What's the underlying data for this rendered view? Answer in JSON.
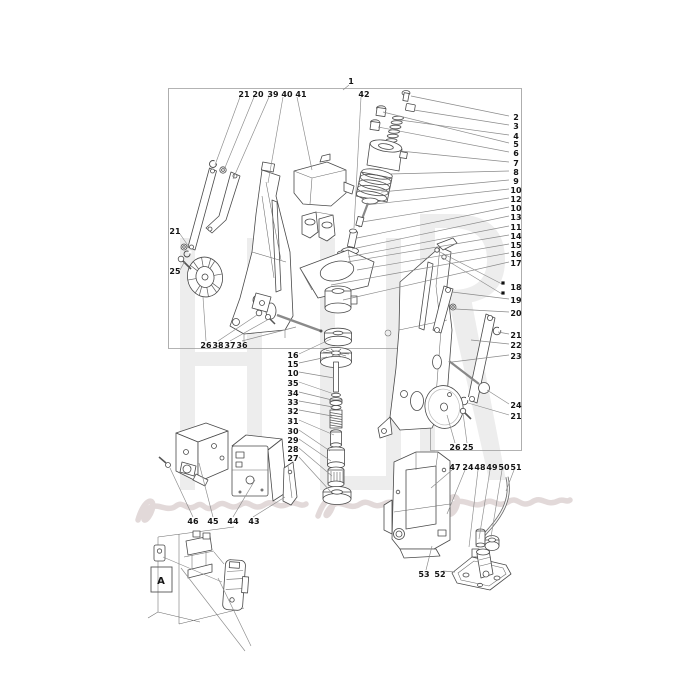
{
  "page": {
    "background": "#ffffff",
    "border_color": "#9a9a9a",
    "drawing_stroke": "#4a4a4a",
    "leader_color": "#8a8a8a",
    "label_color": "#151515",
    "watermark_color": "#ededed",
    "watermark_script_color": "#ddd2d2"
  },
  "figure": {
    "kind": "exploded-parts-diagram",
    "detail_view_label": "A"
  },
  "callouts": [
    {
      "t": "21",
      "x": 244,
      "y": 94
    },
    {
      "t": "20",
      "x": 258,
      "y": 94
    },
    {
      "t": "39",
      "x": 273,
      "y": 94
    },
    {
      "t": "40",
      "x": 287,
      "y": 94
    },
    {
      "t": "41",
      "x": 301,
      "y": 94
    },
    {
      "t": "1",
      "x": 351,
      "y": 81
    },
    {
      "t": "42",
      "x": 364,
      "y": 94
    },
    {
      "t": "2",
      "x": 516,
      "y": 117
    },
    {
      "t": "3",
      "x": 516,
      "y": 126
    },
    {
      "t": "4",
      "x": 516,
      "y": 136
    },
    {
      "t": "5",
      "x": 516,
      "y": 144
    },
    {
      "t": "6",
      "x": 516,
      "y": 153
    },
    {
      "t": "7",
      "x": 516,
      "y": 163
    },
    {
      "t": "8",
      "x": 516,
      "y": 172
    },
    {
      "t": "9",
      "x": 516,
      "y": 181
    },
    {
      "t": "10",
      "x": 516,
      "y": 190
    },
    {
      "t": "12",
      "x": 516,
      "y": 199
    },
    {
      "t": "10",
      "x": 516,
      "y": 208
    },
    {
      "t": "13",
      "x": 516,
      "y": 217
    },
    {
      "t": "11",
      "x": 516,
      "y": 227
    },
    {
      "t": "14",
      "x": 516,
      "y": 236
    },
    {
      "t": "15",
      "x": 516,
      "y": 245
    },
    {
      "t": "16",
      "x": 516,
      "y": 254
    },
    {
      "t": "17",
      "x": 516,
      "y": 263
    },
    {
      "t": "18",
      "x": 516,
      "y": 287
    },
    {
      "t": "19",
      "x": 516,
      "y": 300
    },
    {
      "t": "20",
      "x": 516,
      "y": 313
    },
    {
      "t": "21",
      "x": 516,
      "y": 335
    },
    {
      "t": "22",
      "x": 516,
      "y": 345
    },
    {
      "t": "23",
      "x": 516,
      "y": 356
    },
    {
      "t": "24",
      "x": 516,
      "y": 405
    },
    {
      "t": "21",
      "x": 516,
      "y": 416
    },
    {
      "t": "21",
      "x": 175,
      "y": 231
    },
    {
      "t": "25",
      "x": 175,
      "y": 271
    },
    {
      "t": "26",
      "x": 206,
      "y": 345
    },
    {
      "t": "38",
      "x": 218,
      "y": 345
    },
    {
      "t": "37",
      "x": 230,
      "y": 345
    },
    {
      "t": "36",
      "x": 242,
      "y": 345
    },
    {
      "t": "16",
      "x": 293,
      "y": 355
    },
    {
      "t": "15",
      "x": 293,
      "y": 364
    },
    {
      "t": "10",
      "x": 293,
      "y": 373
    },
    {
      "t": "35",
      "x": 293,
      "y": 383
    },
    {
      "t": "34",
      "x": 293,
      "y": 393
    },
    {
      "t": "33",
      "x": 293,
      "y": 402
    },
    {
      "t": "32",
      "x": 293,
      "y": 411
    },
    {
      "t": "31",
      "x": 293,
      "y": 421
    },
    {
      "t": "30",
      "x": 293,
      "y": 431
    },
    {
      "t": "29",
      "x": 293,
      "y": 440
    },
    {
      "t": "28",
      "x": 293,
      "y": 449
    },
    {
      "t": "27",
      "x": 293,
      "y": 458
    },
    {
      "t": "46",
      "x": 193,
      "y": 521
    },
    {
      "t": "45",
      "x": 213,
      "y": 521
    },
    {
      "t": "44",
      "x": 233,
      "y": 521
    },
    {
      "t": "43",
      "x": 254,
      "y": 521
    },
    {
      "t": "26",
      "x": 455,
      "y": 447
    },
    {
      "t": "25",
      "x": 468,
      "y": 447
    },
    {
      "t": "47",
      "x": 455,
      "y": 467
    },
    {
      "t": "24",
      "x": 468,
      "y": 467
    },
    {
      "t": "48",
      "x": 480,
      "y": 467
    },
    {
      "t": "49",
      "x": 492,
      "y": 467
    },
    {
      "t": "50",
      "x": 504,
      "y": 467
    },
    {
      "t": "51",
      "x": 516,
      "y": 467
    },
    {
      "t": "53",
      "x": 424,
      "y": 574
    },
    {
      "t": "52",
      "x": 440,
      "y": 574
    },
    {
      "t": "A",
      "x": 161,
      "y": 581
    }
  ],
  "leaders": [
    [
      240,
      97,
      215,
      165
    ],
    [
      254,
      97,
      224,
      170
    ],
    [
      269,
      97,
      233,
      179
    ],
    [
      283,
      97,
      268,
      183
    ],
    [
      297,
      97,
      312,
      170
    ],
    [
      349,
      85,
      343,
      90
    ],
    [
      361,
      97,
      354,
      228
    ],
    [
      509,
      116,
      411,
      96
    ],
    [
      509,
      125,
      414,
      110
    ],
    [
      509,
      135,
      400,
      120
    ],
    [
      509,
      143,
      383,
      112
    ],
    [
      509,
      152,
      378,
      127
    ],
    [
      509,
      162,
      400,
      151
    ],
    [
      509,
      171,
      390,
      174
    ],
    [
      509,
      180,
      381,
      192
    ],
    [
      509,
      189,
      366,
      205
    ],
    [
      509,
      198,
      362,
      222
    ],
    [
      509,
      207,
      357,
      238
    ],
    [
      509,
      216,
      352,
      249
    ],
    [
      509,
      226,
      348,
      257
    ],
    [
      509,
      235,
      347,
      262
    ],
    [
      509,
      244,
      357,
      270
    ],
    [
      509,
      253,
      331,
      285
    ],
    [
      509,
      262,
      343,
      300
    ],
    [
      502,
      284,
      438,
      251
    ],
    [
      502,
      294,
      443,
      258
    ],
    [
      509,
      299,
      452,
      292
    ],
    [
      509,
      312,
      455,
      309
    ],
    [
      509,
      334,
      498,
      332
    ],
    [
      509,
      344,
      471,
      340
    ],
    [
      509,
      355,
      452,
      362
    ],
    [
      509,
      404,
      487,
      390
    ],
    [
      509,
      415,
      468,
      403
    ],
    [
      180,
      234,
      189,
      247
    ],
    [
      180,
      270,
      185,
      261
    ],
    [
      206,
      341,
      203,
      297
    ],
    [
      218,
      341,
      257,
      315
    ],
    [
      230,
      341,
      269,
      319
    ],
    [
      242,
      341,
      296,
      327
    ],
    [
      299,
      354,
      331,
      339
    ],
    [
      299,
      363,
      327,
      357
    ],
    [
      299,
      372,
      334,
      378
    ],
    [
      299,
      382,
      334,
      394
    ],
    [
      299,
      392,
      332,
      400
    ],
    [
      299,
      401,
      333,
      407
    ],
    [
      299,
      410,
      332,
      416
    ],
    [
      299,
      420,
      334,
      435
    ],
    [
      299,
      430,
      330,
      451
    ],
    [
      299,
      439,
      331,
      461
    ],
    [
      299,
      448,
      332,
      476
    ],
    [
      299,
      457,
      331,
      492
    ],
    [
      193,
      517,
      170,
      468
    ],
    [
      213,
      517,
      199,
      463
    ],
    [
      233,
      517,
      255,
      480
    ],
    [
      253,
      517,
      285,
      497
    ],
    [
      455,
      443,
      447,
      415
    ],
    [
      467,
      443,
      463,
      413
    ],
    [
      452,
      470,
      431,
      488
    ],
    [
      465,
      470,
      447,
      514
    ],
    [
      478,
      470,
      469,
      547
    ],
    [
      490,
      470,
      479,
      539
    ],
    [
      502,
      470,
      491,
      537
    ],
    [
      514,
      470,
      506,
      491
    ],
    [
      426,
      570,
      432,
      546
    ],
    [
      443,
      571,
      455,
      572
    ],
    [
      163,
      557,
      222,
      582
    ],
    [
      181,
      568,
      245,
      651
    ],
    [
      218,
      578,
      251,
      646
    ]
  ],
  "bullets": [
    [
      503,
      283
    ],
    [
      503,
      293
    ]
  ]
}
